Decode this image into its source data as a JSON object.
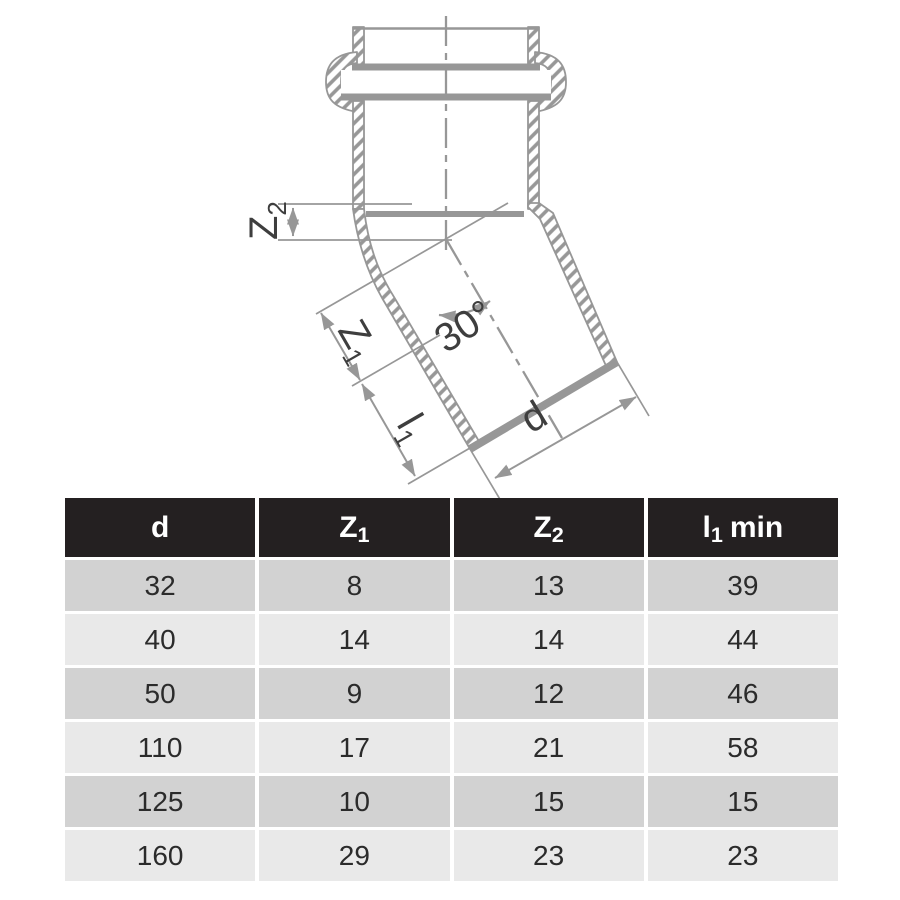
{
  "diagram": {
    "angle_label": "30°",
    "labels": {
      "z2": {
        "base": "Z",
        "sub": "2"
      },
      "z1": {
        "base": "Z",
        "sub": "1"
      },
      "l1": {
        "base": "l",
        "sub": "1"
      },
      "d": {
        "base": "d"
      }
    },
    "colors": {
      "drawing_gray": "#979797",
      "label_color": "#3e3e3e"
    }
  },
  "table": {
    "headers": [
      {
        "base": "d",
        "sub": "",
        "suffix": ""
      },
      {
        "base": "Z",
        "sub": "1",
        "suffix": ""
      },
      {
        "base": "Z",
        "sub": "2",
        "suffix": ""
      },
      {
        "base": "l",
        "sub": "1",
        "suffix": "min"
      }
    ],
    "rows": [
      [
        "32",
        "8",
        "13",
        "39"
      ],
      [
        "40",
        "14",
        "14",
        "44"
      ],
      [
        "50",
        "9",
        "12",
        "46"
      ],
      [
        "110",
        "17",
        "21",
        "58"
      ],
      [
        "125",
        "10",
        "15",
        "15"
      ],
      [
        "160",
        "29",
        "23",
        "23"
      ]
    ],
    "colors": {
      "header_bg": "#242021",
      "header_text": "#ffffff",
      "row_dark": "#d2d2d2",
      "row_light": "#e9e9e9",
      "cell_text": "#2b2b2b"
    }
  }
}
